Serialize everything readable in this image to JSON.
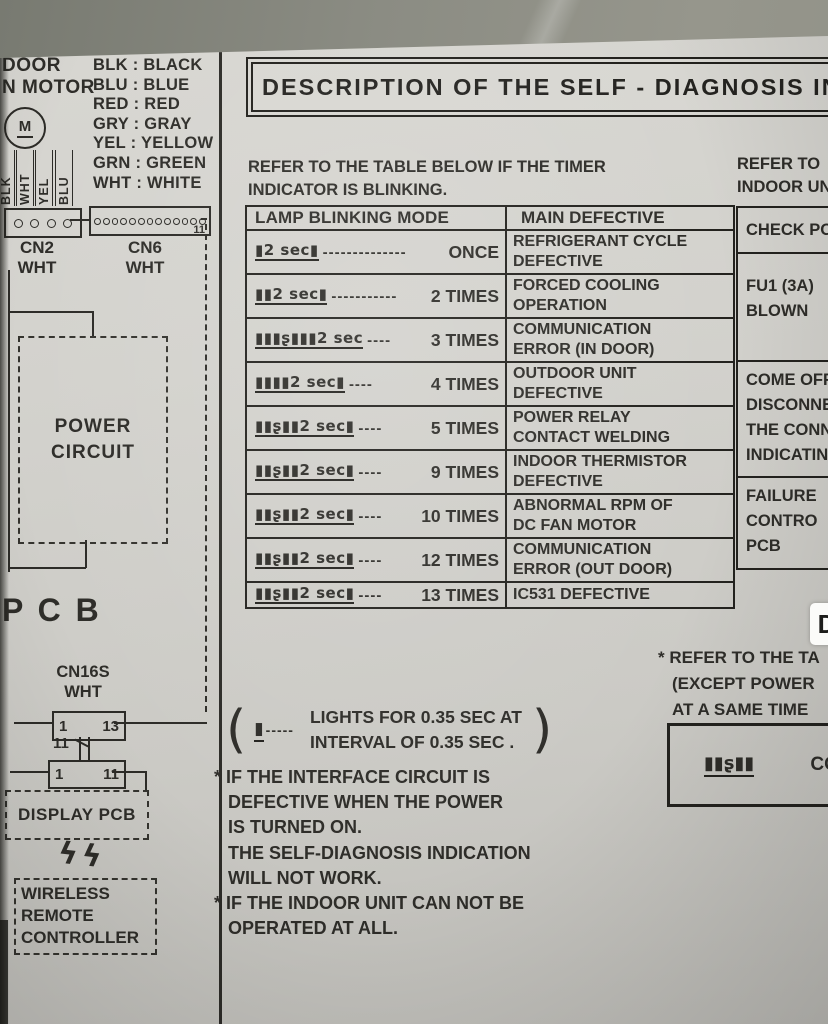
{
  "title": "DESCRIPTION OF THE SELF - DIAGNOSIS IN",
  "colors": {
    "paper": "#d3d2cd",
    "ink": "#2e2d29",
    "background": "#8b8c83"
  },
  "left_panel": {
    "fan_label_line1": "DOOR",
    "fan_label_line2": "N MOTOR",
    "motor_letter": "M",
    "wire_labels": [
      "BLK",
      "WHT",
      "YEL",
      "BLU"
    ],
    "color_legend": [
      "BLK : BLACK",
      "BLU : BLUE",
      "RED : RED",
      "GRY : GRAY",
      "YEL : YELLOW",
      "GRN : GREEN",
      "WHT : WHITE"
    ],
    "cn2_name": "CN2",
    "cn2_color": "WHT",
    "cn6_name": "CN6",
    "cn6_color": "WHT",
    "cn6_pin": "11",
    "power_circuit_line1": "POWER",
    "power_circuit_line2": "CIRCUIT",
    "pcb_label": "P C B",
    "cn16s_name": "CN16S",
    "cn16s_color": "WHT",
    "conn1_left": "1",
    "conn1_right": "13",
    "conn_mid": "11",
    "conn2_left": "1",
    "conn2_right": "11",
    "display_pcb": "DISPLAY  PCB",
    "wireless_bolts": "ϟϟ",
    "wireless_line1": "WIRELESS",
    "wireless_line2": "REMOTE",
    "wireless_line3": "CONTROLLER"
  },
  "main": {
    "intro_line1": "REFER TO THE TABLE BELOW IF THE TIMER",
    "intro_line2": "INDICATOR IS BLINKING.",
    "table": {
      "col1_header": "LAMP BLINKING MODE",
      "col2_header": "MAIN DEFECTIVE",
      "rows": [
        {
          "pattern": "▮2 sec▮",
          "dashes": "--------------",
          "count": "ONCE",
          "d1": "REFRIGERANT CYCLE",
          "d2": "DEFECTIVE"
        },
        {
          "pattern": "▮▮2 sec▮",
          "dashes": "-----------",
          "count": "2  TIMES",
          "d1": "FORCED COOLING",
          "d2": "OPERATION"
        },
        {
          "pattern": "▮▮▮ʂ▮▮▮2 sec",
          "dashes": "----",
          "count": "3 TIMES",
          "d1": "COMMUNICATION",
          "d2": "ERROR (IN DOOR)"
        },
        {
          "pattern": "▮▮▮▮2 sec▮",
          "dashes": "----",
          "count": "4 TIMES",
          "d1": "OUTDOOR UNIT",
          "d2": "DEFECTIVE"
        },
        {
          "pattern": "▮▮ʂ▮▮2 sec▮",
          "dashes": "----",
          "count": "5 TIMES",
          "d1": "POWER RELAY",
          "d2": "CONTACT WELDING"
        },
        {
          "pattern": "▮▮ʂ▮▮2 sec▮",
          "dashes": "----",
          "count": "9 TIMES",
          "d1": "INDOOR THERMISTOR",
          "d2": "DEFECTIVE"
        },
        {
          "pattern": "▮▮ʂ▮▮2 sec▮",
          "dashes": "----",
          "count": "10 TIMES",
          "d1": "ABNORMAL RPM OF",
          "d2": "DC FAN MOTOR"
        },
        {
          "pattern": "▮▮ʂ▮▮2 sec▮",
          "dashes": "----",
          "count": "12 TIMES",
          "d1": "COMMUNICATION",
          "d2": "ERROR (OUT DOOR)"
        },
        {
          "pattern": "▮▮ʂ▮▮2 sec▮",
          "dashes": "----",
          "count": "13 TIMES",
          "d1": "IC531  DEFECTIVE",
          "d2": ""
        }
      ]
    },
    "paren_open": "(",
    "paren_close": ")",
    "legend_symbol": "▮",
    "legend_dashes": "-----",
    "legend_line1": "LIGHTS FOR 0.35 SEC AT",
    "legend_line2": "INTERVAL OF 0.35 SEC .",
    "notes": [
      "* IF THE INTERFACE CIRCUIT IS",
      "DEFECTIVE WHEN THE POWER",
      "IS TURNED ON.",
      "THE SELF-DIAGNOSIS INDICATION",
      "WILL NOT WORK.",
      "* IF THE INDOOR UNIT CAN NOT BE",
      "OPERATED AT ALL."
    ]
  },
  "right_panel": {
    "refer_line1": "REFER TO",
    "refer_line2": "INDOOR UN",
    "check_header": "CHECK PO",
    "check_rows": [
      [
        "FU1 (3A)",
        "BLOWN"
      ],
      [
        "COME OFF",
        "DISCONNE",
        "THE CONN",
        "INDICATIN"
      ],
      [
        "FAILURE",
        "CONTRO",
        "PCB"
      ]
    ],
    "footnote_line1": "* REFER TO THE TA",
    "footnote_line2": "(EXCEPT POWER",
    "footnote_line3": "AT A SAME TIME",
    "footnote_pattern": "▮▮ʂ▮▮",
    "footnote_pattern_text": "CO"
  },
  "overlay_badge": "D"
}
